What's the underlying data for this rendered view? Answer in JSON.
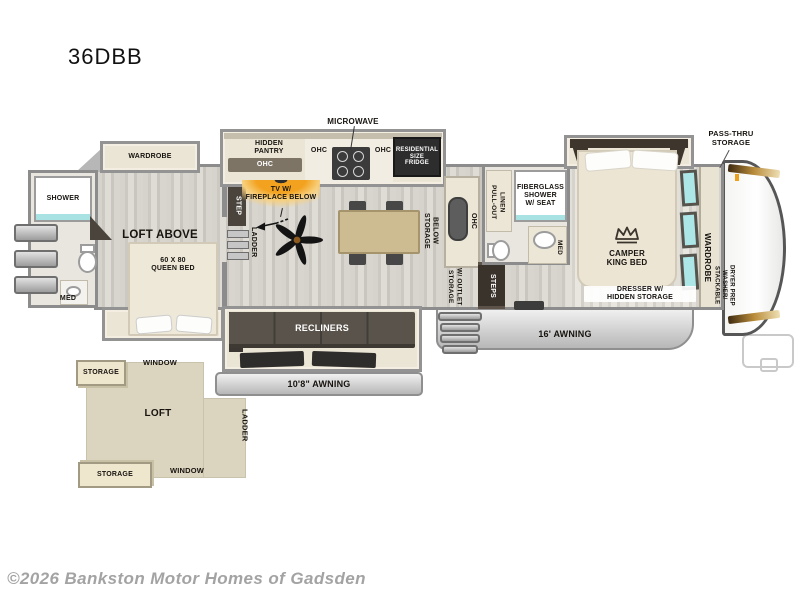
{
  "title": "36DBB",
  "copyright": "©2026 Bankston Motor Homes of Gadsden",
  "labels": {
    "microwave": "MICROWAVE",
    "hidden_pantry": "HIDDEN\nPANTRY",
    "ohc": "OHC",
    "fridge": "RESIDENTIAL\nSIZE\nFRIDGE",
    "tv_fireplace": "TV W/\nFIREPLACE BELOW",
    "step": "STEP",
    "ladder": "LADDER",
    "wardrobe": "WARDROBE",
    "shower": "SHOWER",
    "med": "MED",
    "loft_above": "LOFT ABOVE",
    "queen_bed": "60 X 80\nQUEEN BED",
    "storage_below": "STORAGE\nBELOW",
    "storage_outlet": "STORAGE\nW/ OUTLET",
    "steps": "STEPS",
    "pull_out_linen": "PULL-OUT\nLINEN",
    "fiberglass_shower": "FIBERGLASS\nSHOWER\nW/ SEAT",
    "camper_king_bed": "CAMPER\nKING BED",
    "pass_thru": "PASS-THRU\nSTORAGE",
    "washer_dryer": "STACKABLE\nWASHER/\nDRYER PREP",
    "dresser": "DRESSER W/\nHIDDEN STORAGE",
    "recliners": "RECLINERS",
    "awning_small": "10'8\" AWNING",
    "awning_large": "16' AWNING",
    "storage": "STORAGE",
    "window": "WINDOW",
    "loft": "LOFT"
  },
  "colors": {
    "accent_orange": "#f2a21f",
    "glass_teal": "#a9e2e3",
    "wall_gray": "#8c8c8c",
    "counter_cream": "#ece6d6",
    "dark_furniture": "#57504a"
  }
}
